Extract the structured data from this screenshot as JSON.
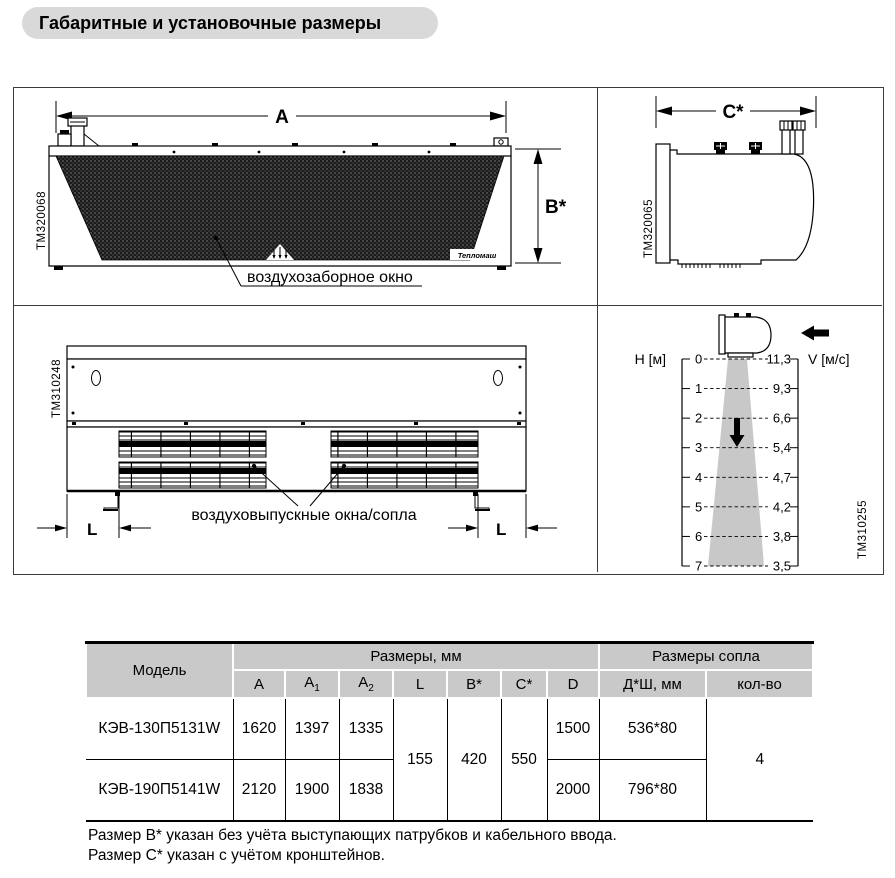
{
  "title": "Габаритные и установочные размеры",
  "drawings": {
    "front": {
      "code": "TM320068",
      "dim_width": "A",
      "dim_height": "B*",
      "intake_label": "воздухозаборное окно",
      "brand": "Тепломаш"
    },
    "side": {
      "code": "TM320065",
      "dim_depth": "C*"
    },
    "bottom": {
      "code": "TM310248",
      "dim_l_left": "L",
      "dim_l_right": "L",
      "outlet_label": "воздуховыпускные окна/сопла"
    }
  },
  "chart_data": {
    "type": "line",
    "title": "",
    "xlabel": "H [м]",
    "ylabel": "V [м/с]",
    "x": [
      0,
      1,
      2,
      3,
      4,
      5,
      6,
      7
    ],
    "values": [
      11.3,
      9.3,
      6.6,
      5.4,
      4.7,
      4.2,
      3.8,
      3.5
    ],
    "h_labels": [
      "0",
      "1",
      "2",
      "3",
      "4",
      "5",
      "6",
      "7"
    ],
    "v_labels": [
      "11,3",
      "9,3",
      "6,6",
      "5,4",
      "4,7",
      "4,2",
      "3,8",
      "3,5"
    ],
    "ylim": [
      0,
      7
    ],
    "grid": "dashed-level-lines",
    "legend": "none",
    "code": "TM310255"
  },
  "table": {
    "header": {
      "model": "Модель",
      "dims_group": "Размеры, мм",
      "nozzle_group": "Размеры сопла",
      "col_a": "A",
      "col_a1": "A",
      "col_a1_sub": "1",
      "col_a2": "A",
      "col_a2_sub": "2",
      "col_l": "L",
      "col_b": "B*",
      "col_c": "C*",
      "col_d": "D",
      "col_nozzle_size": "Д*Ш, мм",
      "col_qty": "кол-во"
    },
    "rows": [
      {
        "model": "КЭВ-130П5131W",
        "a": "1620",
        "a1": "1397",
        "a2": "1335",
        "d": "1500",
        "nozzle_size": "536*80"
      },
      {
        "model": "КЭВ-190П5141W",
        "a": "2120",
        "a1": "1900",
        "a2": "1838",
        "d": "2000",
        "nozzle_size": "796*80"
      }
    ],
    "shared": {
      "l": "155",
      "b": "420",
      "c": "550",
      "qty": "4"
    }
  },
  "notes": [
    "Размер B* указан без учёта выступающих патрубков и кабельного ввода.",
    "Размер C* указан с учётом кронштейнов."
  ]
}
